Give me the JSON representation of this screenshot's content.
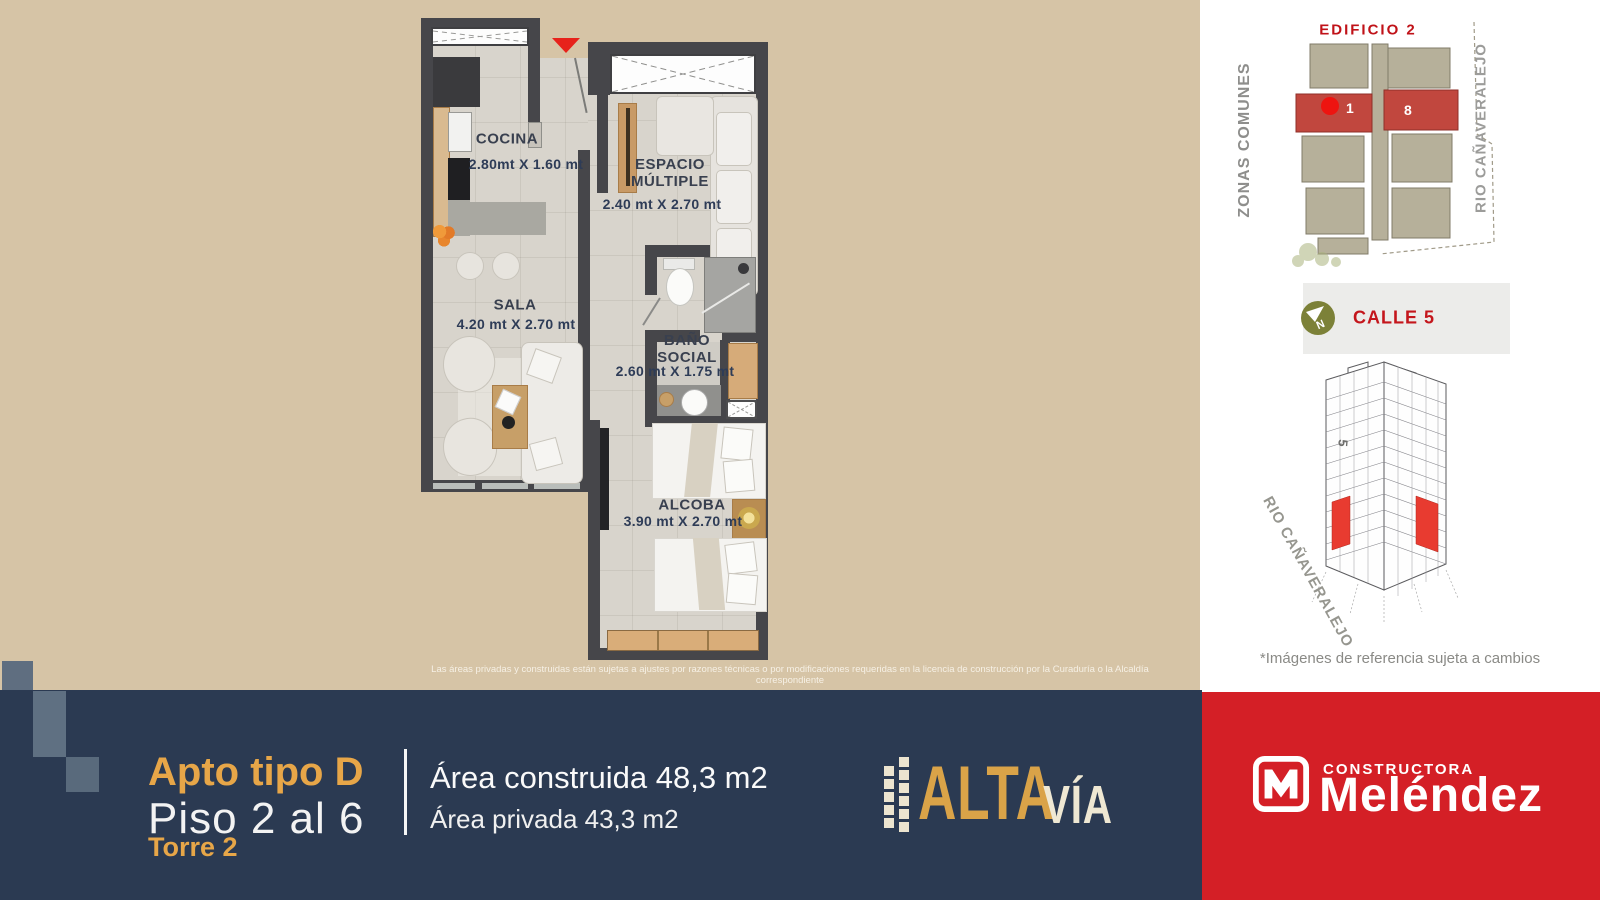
{
  "plan": {
    "rooms": [
      {
        "name": "COCINA",
        "dims": "2.80mt X 1.60 mt"
      },
      {
        "name": "ESPACIO\nMÚLTIPLE",
        "dims": "2.40 mt X 2.70 mt"
      },
      {
        "name": "SALA",
        "dims": "4.20 mt X 2.70 mt"
      },
      {
        "name": "BAÑO\nSOCIAL",
        "dims": "2.60 mt X 1.75 mt"
      },
      {
        "name": "ALCOBA",
        "dims": "3.90 mt X 2.70 mt"
      }
    ],
    "disclaimer": "Las áreas privadas y construidas están sujetas a ajustes por razones técnicas o por modificaciones requeridas en la licencia de construcción por la Curaduría o la Alcaldía correspondiente"
  },
  "site": {
    "title": "EDIFICIO 2",
    "left_vertical": "ZONAS COMUNES",
    "right_vertical": "RIO CAÑAVERALEJO",
    "unit_left": "1",
    "unit_right": "8",
    "street": "CALLE 5",
    "compass": "N",
    "diagonal": "RIO CAÑAVERALEJO",
    "street_number": "5",
    "caption": "*Imágenes de referencia sujeta a cambios"
  },
  "footer": {
    "apt": "Apto tipo D",
    "floors": "Piso 2 al 6",
    "tower": "Torre 2",
    "area_built": "Área construida 48,3 m2",
    "area_private": "Área privada 43,3 m2",
    "brand_alta": "ALTA",
    "brand_via": "VÍA",
    "builder_top": "CONSTRUCTORA",
    "builder_name": "Meléndez"
  },
  "colors": {
    "background": "#d6c4a6",
    "navy": "#2b3a52",
    "gold": "#e7a648",
    "red_panel": "#d41f26",
    "wall": "#46464a",
    "site_highlight": "#c1473e",
    "label_red": "#c4161c"
  }
}
